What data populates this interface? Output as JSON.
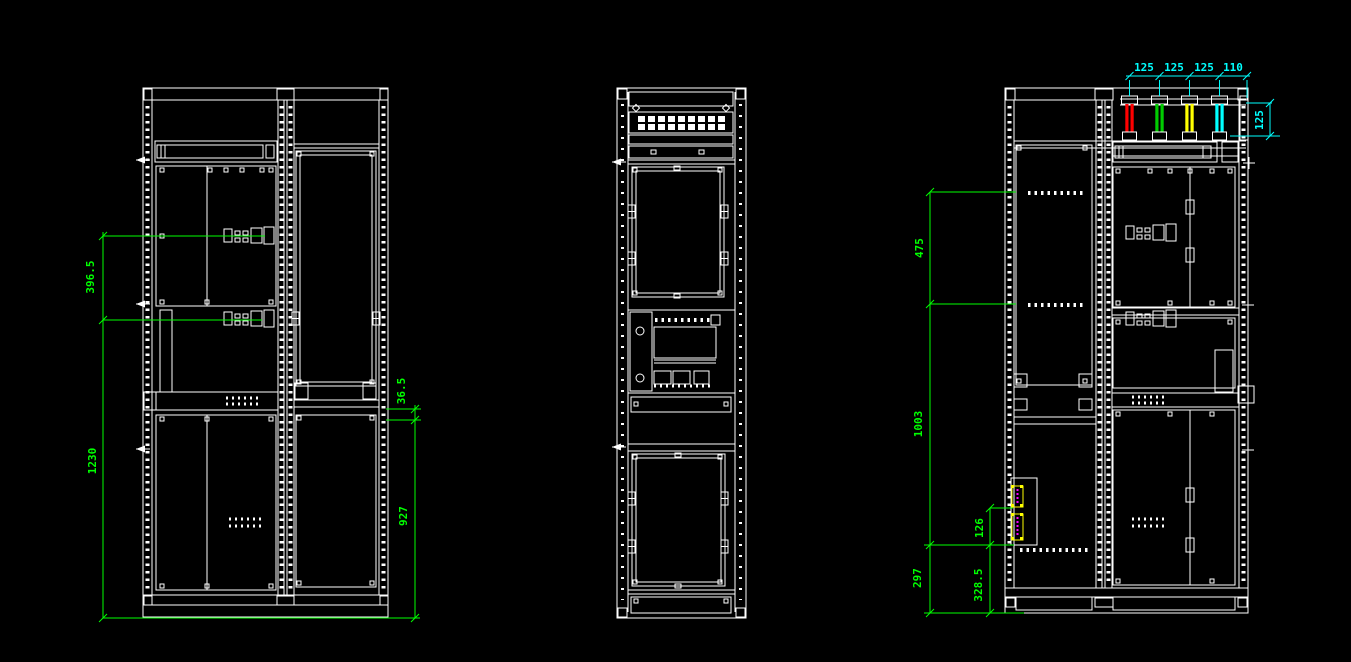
{
  "colors": {
    "background": "#000000",
    "linework": "#ffffff",
    "dimension_green": "#00ff00",
    "dimension_cyan": "#00ffff",
    "component_highlight": "#ffff00",
    "component_inner": "#ff00ff",
    "busbars": [
      "#ff0000",
      "#00cc00",
      "#ffff00",
      "#00ffff"
    ]
  },
  "dimensions": {
    "left_view": {
      "upper_section": "396.5",
      "overall_height": "1230",
      "small_gap": "36.5",
      "lower_section": "927"
    },
    "right_view": {
      "upper_section": "475",
      "middle_section": "1003",
      "bottom_section": "297",
      "component_gap": "126",
      "component_height": "328.5"
    },
    "busbar": {
      "spacings": [
        "125",
        "125",
        "125",
        "110"
      ],
      "depth": "125"
    }
  }
}
